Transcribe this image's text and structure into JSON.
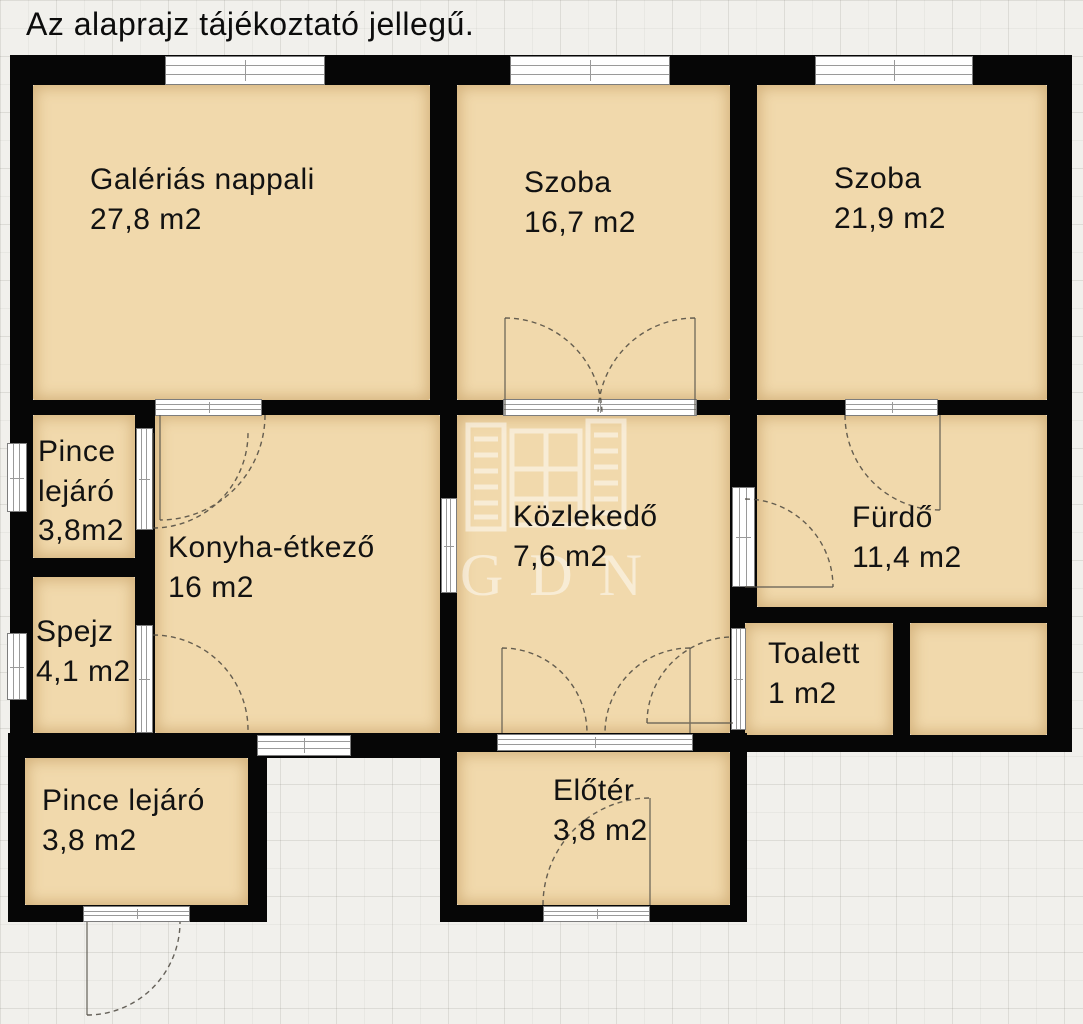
{
  "title": "Az alaprajz tájékoztató jellegű.",
  "watermark": {
    "text": "GDN"
  },
  "rooms": {
    "nappali": {
      "name": "Galériás nappali",
      "area": "27,8 m2"
    },
    "szoba1": {
      "name": "Szoba",
      "area": "16,7 m2"
    },
    "szoba2": {
      "name": "Szoba",
      "area": "21,9 m2"
    },
    "pince_felso": {
      "name": "Pince lejáró",
      "area": "3,8m2"
    },
    "konyha": {
      "name": "Konyha-étkező",
      "area": "16 m2"
    },
    "kozlekedo": {
      "name": "Közlekedő",
      "area": "7,6 m2"
    },
    "furdo": {
      "name": "Fürdő",
      "area": "11,4 m2"
    },
    "spejz": {
      "name": "Spejz",
      "area": "4,1 m2"
    },
    "toalett": {
      "name": "Toalett",
      "area": "1 m2"
    },
    "pince_also": {
      "name": "Pince lejáró",
      "area": "3,8 m2"
    },
    "eloter": {
      "name": "Előtér",
      "area": "3,8 m2"
    }
  },
  "colors": {
    "room_fill": "#f1d9ac",
    "wall": "#060606",
    "background": "#f1f0ec"
  }
}
